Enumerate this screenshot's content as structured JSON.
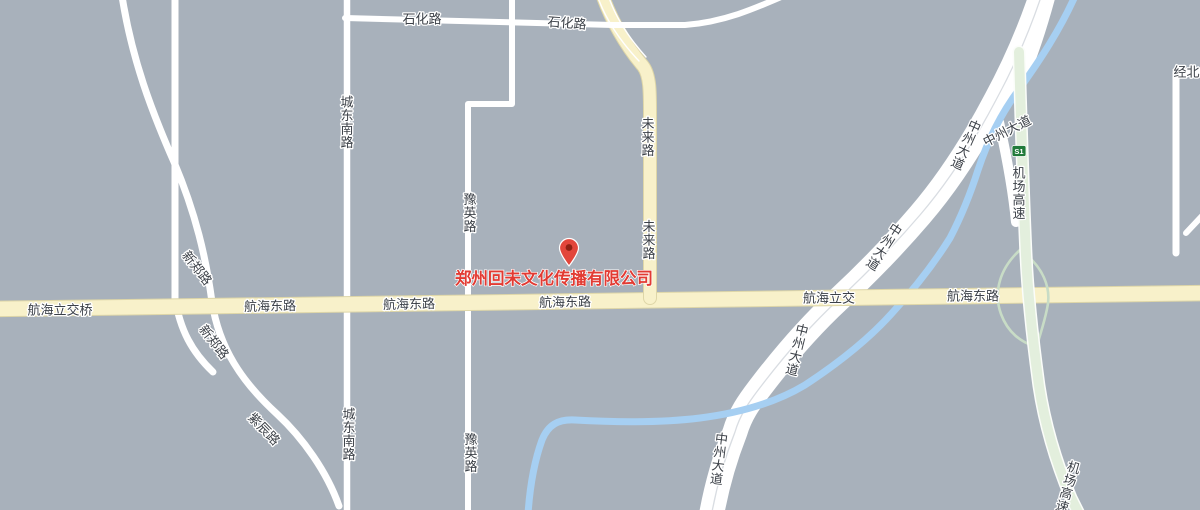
{
  "map": {
    "colors": {
      "background": "#a8b1bb",
      "road_white": "#ffffff",
      "road_centerline": "#d9dde2",
      "road_yellow": "#f8f1ca",
      "road_yellow_edge": "#ded6a8",
      "river_blue": "#a6cff2",
      "expressway_green": "#e3efdd",
      "expressway_edge": "#fbfdfa",
      "ramp_green": "#c8dcc6",
      "label_text": "#3c4148",
      "label_halo": "#ffffff",
      "poi_red": "#e23b33",
      "marker_red": "#e2463b",
      "marker_hole": "#8f2114",
      "shield_green": "#217a3a",
      "shield_text": "#ffffff"
    },
    "poi": {
      "name": "郑州回未文化传播有限公司",
      "label_x": 554,
      "label_y": 279,
      "marker_x": 569,
      "marker_y": 249
    },
    "shield": {
      "code": "S1",
      "x": 1019,
      "y": 151
    },
    "road_labels": [
      {
        "text": "石化路",
        "x": 422,
        "y": 19,
        "rot": 0,
        "mode": "h"
      },
      {
        "text": "石化路",
        "x": 567,
        "y": 23,
        "rot": 4,
        "mode": "h"
      },
      {
        "text": "经北二",
        "x": 1193,
        "y": 72,
        "rot": 0,
        "mode": "h"
      },
      {
        "text": "新郑路",
        "x": 197,
        "y": 268,
        "rot": 52,
        "mode": "h"
      },
      {
        "text": "新郑路",
        "x": 214,
        "y": 342,
        "rot": 52,
        "mode": "h"
      },
      {
        "text": "紫辰路",
        "x": 264,
        "y": 429,
        "rot": 46,
        "mode": "h"
      },
      {
        "text": "航海立交桥",
        "x": 60,
        "y": 310,
        "rot": 0,
        "mode": "h"
      },
      {
        "text": "航海东路",
        "x": 270,
        "y": 306,
        "rot": -1,
        "mode": "h"
      },
      {
        "text": "航海东路",
        "x": 409,
        "y": 304,
        "rot": -1,
        "mode": "h"
      },
      {
        "text": "航海东路",
        "x": 565,
        "y": 302,
        "rot": -1,
        "mode": "h"
      },
      {
        "text": "航海立交",
        "x": 829,
        "y": 298,
        "rot": 0,
        "mode": "h"
      },
      {
        "text": "航海东路",
        "x": 973,
        "y": 296,
        "rot": 0,
        "mode": "h"
      },
      {
        "text": "中州大道",
        "x": 1007,
        "y": 131,
        "rot": -27,
        "mode": "h"
      },
      {
        "text": "城东南路",
        "x": 347,
        "y": 122,
        "rot": 0,
        "mode": "v"
      },
      {
        "text": "城东南路",
        "x": 349,
        "y": 434,
        "rot": 0,
        "mode": "v"
      },
      {
        "text": "豫英路",
        "x": 470,
        "y": 213,
        "rot": 0,
        "mode": "v"
      },
      {
        "text": "豫英路",
        "x": 471,
        "y": 453,
        "rot": 0,
        "mode": "v"
      },
      {
        "text": "未来路",
        "x": 648,
        "y": 137,
        "rot": 0,
        "mode": "v"
      },
      {
        "text": "未来路",
        "x": 649,
        "y": 240,
        "rot": 0,
        "mode": "v"
      },
      {
        "text": "中州大道",
        "x": 966,
        "y": 145,
        "rot": 24,
        "mode": "v"
      },
      {
        "text": "中州大道",
        "x": 884,
        "y": 247,
        "rot": 33,
        "mode": "v"
      },
      {
        "text": "中州大道",
        "x": 797,
        "y": 350,
        "rot": 14,
        "mode": "v"
      },
      {
        "text": "中州大道",
        "x": 719,
        "y": 459,
        "rot": 7,
        "mode": "v"
      },
      {
        "text": "机场高速",
        "x": 1019,
        "y": 193,
        "rot": 0,
        "mode": "v"
      },
      {
        "text": "机场高速",
        "x": 1068,
        "y": 487,
        "rot": 16,
        "mode": "v"
      }
    ]
  }
}
